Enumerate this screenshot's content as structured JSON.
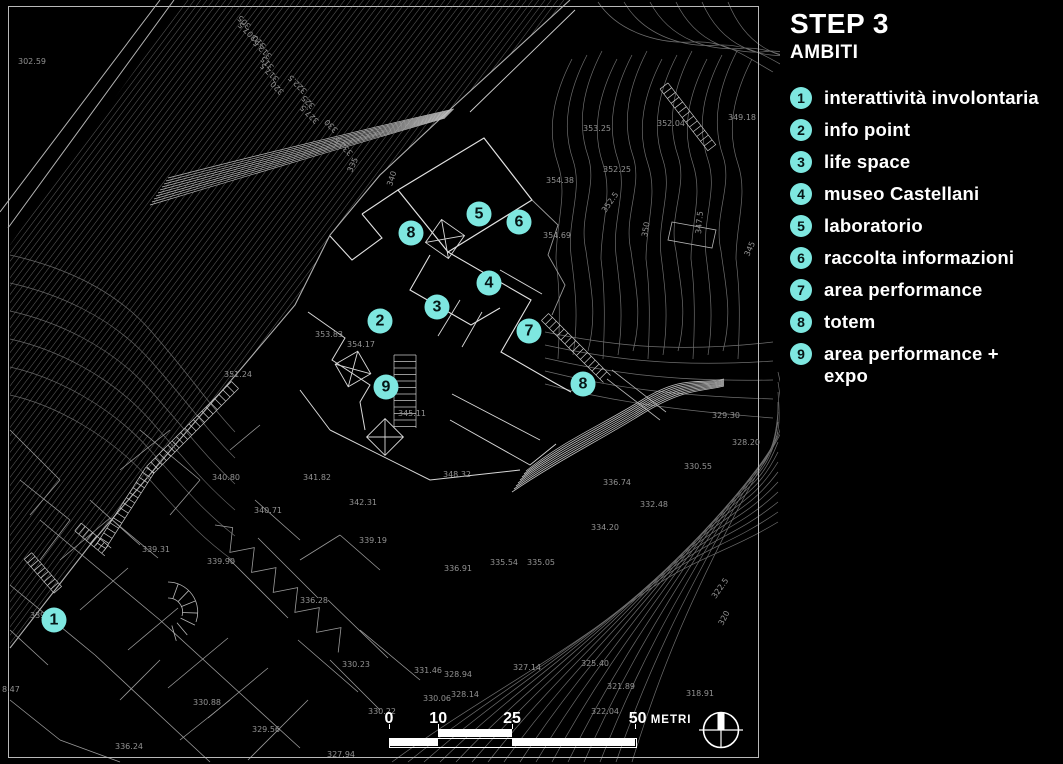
{
  "title": {
    "step": "STEP 3",
    "subtitle": "AMBITI"
  },
  "legend": {
    "items": [
      {
        "n": "1",
        "label": "interattività involontaria"
      },
      {
        "n": "2",
        "label": "info point"
      },
      {
        "n": "3",
        "label": "life space"
      },
      {
        "n": "4",
        "label": "museo Castellani"
      },
      {
        "n": "5",
        "label": "laboratorio"
      },
      {
        "n": "6",
        "label": "raccolta informazioni"
      },
      {
        "n": "7",
        "label": "area performance"
      },
      {
        "n": "8",
        "label": "totem"
      },
      {
        "n": "9",
        "label": "area performance +\nexpo"
      }
    ]
  },
  "map": {
    "markers": [
      {
        "n": "1",
        "x": 54,
        "y": 620
      },
      {
        "n": "2",
        "x": 380,
        "y": 321
      },
      {
        "n": "3",
        "x": 437,
        "y": 307
      },
      {
        "n": "4",
        "x": 489,
        "y": 283
      },
      {
        "n": "5",
        "x": 479,
        "y": 214
      },
      {
        "n": "6",
        "x": 519,
        "y": 222
      },
      {
        "n": "7",
        "x": 529,
        "y": 331
      },
      {
        "n": "8",
        "x": 411,
        "y": 233
      },
      {
        "n": "8",
        "x": 583,
        "y": 384
      },
      {
        "n": "9",
        "x": 386,
        "y": 387
      }
    ],
    "elevation_labels": [
      {
        "t": "302.59",
        "x": 18,
        "y": 58
      },
      {
        "t": "353.25",
        "x": 583,
        "y": 125
      },
      {
        "t": "352.04",
        "x": 657,
        "y": 120
      },
      {
        "t": "349.18",
        "x": 728,
        "y": 114
      },
      {
        "t": "352.25",
        "x": 603,
        "y": 166
      },
      {
        "t": "354.38",
        "x": 546,
        "y": 177
      },
      {
        "t": "354.69",
        "x": 543,
        "y": 232
      },
      {
        "t": "353.83",
        "x": 315,
        "y": 331
      },
      {
        "t": "354.17",
        "x": 347,
        "y": 341
      },
      {
        "t": "351.24",
        "x": 224,
        "y": 371
      },
      {
        "t": "345.11",
        "x": 398,
        "y": 410
      },
      {
        "t": "340.80",
        "x": 212,
        "y": 474
      },
      {
        "t": "341.82",
        "x": 303,
        "y": 474
      },
      {
        "t": "348.32",
        "x": 443,
        "y": 471
      },
      {
        "t": "342.31",
        "x": 349,
        "y": 499
      },
      {
        "t": "340.71",
        "x": 254,
        "y": 507
      },
      {
        "t": "339.19",
        "x": 359,
        "y": 537
      },
      {
        "t": "339.31",
        "x": 142,
        "y": 546
      },
      {
        "t": "339.90",
        "x": 207,
        "y": 558
      },
      {
        "t": "339.93",
        "x": 30,
        "y": 612
      },
      {
        "t": "336.91",
        "x": 444,
        "y": 565
      },
      {
        "t": "335.54",
        "x": 490,
        "y": 559
      },
      {
        "t": "335.05",
        "x": 527,
        "y": 559
      },
      {
        "t": "334.20",
        "x": 591,
        "y": 524
      },
      {
        "t": "332.48",
        "x": 640,
        "y": 501
      },
      {
        "t": "336.74",
        "x": 603,
        "y": 479
      },
      {
        "t": "330.55",
        "x": 684,
        "y": 463
      },
      {
        "t": "329.30",
        "x": 712,
        "y": 412
      },
      {
        "t": "328.20",
        "x": 732,
        "y": 439
      },
      {
        "t": "325.40",
        "x": 581,
        "y": 660
      },
      {
        "t": "321.89",
        "x": 607,
        "y": 683
      },
      {
        "t": "318.91",
        "x": 686,
        "y": 690
      },
      {
        "t": "322.04",
        "x": 591,
        "y": 708
      },
      {
        "t": "330.23",
        "x": 342,
        "y": 661
      },
      {
        "t": "331.46",
        "x": 414,
        "y": 667
      },
      {
        "t": "328.94",
        "x": 444,
        "y": 671
      },
      {
        "t": "327.14",
        "x": 513,
        "y": 664
      },
      {
        "t": "330.06",
        "x": 423,
        "y": 695
      },
      {
        "t": "328.14",
        "x": 451,
        "y": 691
      },
      {
        "t": "330.22",
        "x": 368,
        "y": 708
      },
      {
        "t": "327.94",
        "x": 327,
        "y": 751
      },
      {
        "t": "336.24",
        "x": 115,
        "y": 743
      },
      {
        "t": "330.88",
        "x": 193,
        "y": 699
      },
      {
        "t": "329.56",
        "x": 252,
        "y": 726
      },
      {
        "t": "336.28",
        "x": 300,
        "y": 597
      },
      {
        "t": "8.47",
        "x": 2,
        "y": 686
      },
      {
        "t": "305",
        "x": 250,
        "y": 23,
        "r": 225
      },
      {
        "t": "307.5",
        "x": 256,
        "y": 35,
        "r": 225
      },
      {
        "t": "310",
        "x": 265,
        "y": 43,
        "r": 225
      },
      {
        "t": "312.5",
        "x": 271,
        "y": 53,
        "r": 225
      },
      {
        "t": "315",
        "x": 273,
        "y": 64,
        "r": 225
      },
      {
        "t": "317.5",
        "x": 278,
        "y": 76,
        "r": 225
      },
      {
        "t": "320",
        "x": 283,
        "y": 89,
        "r": 225
      },
      {
        "t": "322.5",
        "x": 306,
        "y": 88,
        "r": 225
      },
      {
        "t": "325",
        "x": 314,
        "y": 103,
        "r": 225
      },
      {
        "t": "327.5",
        "x": 318,
        "y": 118,
        "r": 225
      },
      {
        "t": "330",
        "x": 337,
        "y": 127,
        "r": 225
      },
      {
        "t": "332.5",
        "x": 352,
        "y": 150,
        "r": 225
      },
      {
        "t": "335",
        "x": 350,
        "y": 168,
        "r": -65
      },
      {
        "t": "340",
        "x": 390,
        "y": 182,
        "r": -72
      },
      {
        "t": "352.5",
        "x": 604,
        "y": 208,
        "r": -55
      },
      {
        "t": "350",
        "x": 645,
        "y": 233,
        "r": -80
      },
      {
        "t": "347.5",
        "x": 699,
        "y": 230,
        "r": -85
      },
      {
        "t": "345",
        "x": 747,
        "y": 252,
        "r": -65
      },
      {
        "t": "322.5",
        "x": 714,
        "y": 594,
        "r": -55
      },
      {
        "t": "320",
        "x": 721,
        "y": 621,
        "r": -62
      }
    ],
    "scalebar": {
      "ticks": [
        {
          "label": "0",
          "m": 0
        },
        {
          "label": "10",
          "m": 10
        },
        {
          "label": "25",
          "m": 25
        },
        {
          "label": "50",
          "m": 50
        }
      ],
      "unit": "METRI"
    }
  },
  "colors": {
    "accent": "#7EE7E0",
    "background": "#000000",
    "line_dim": "#6E6E6E",
    "line_bright": "#E0E0E0",
    "label": "#929292"
  }
}
